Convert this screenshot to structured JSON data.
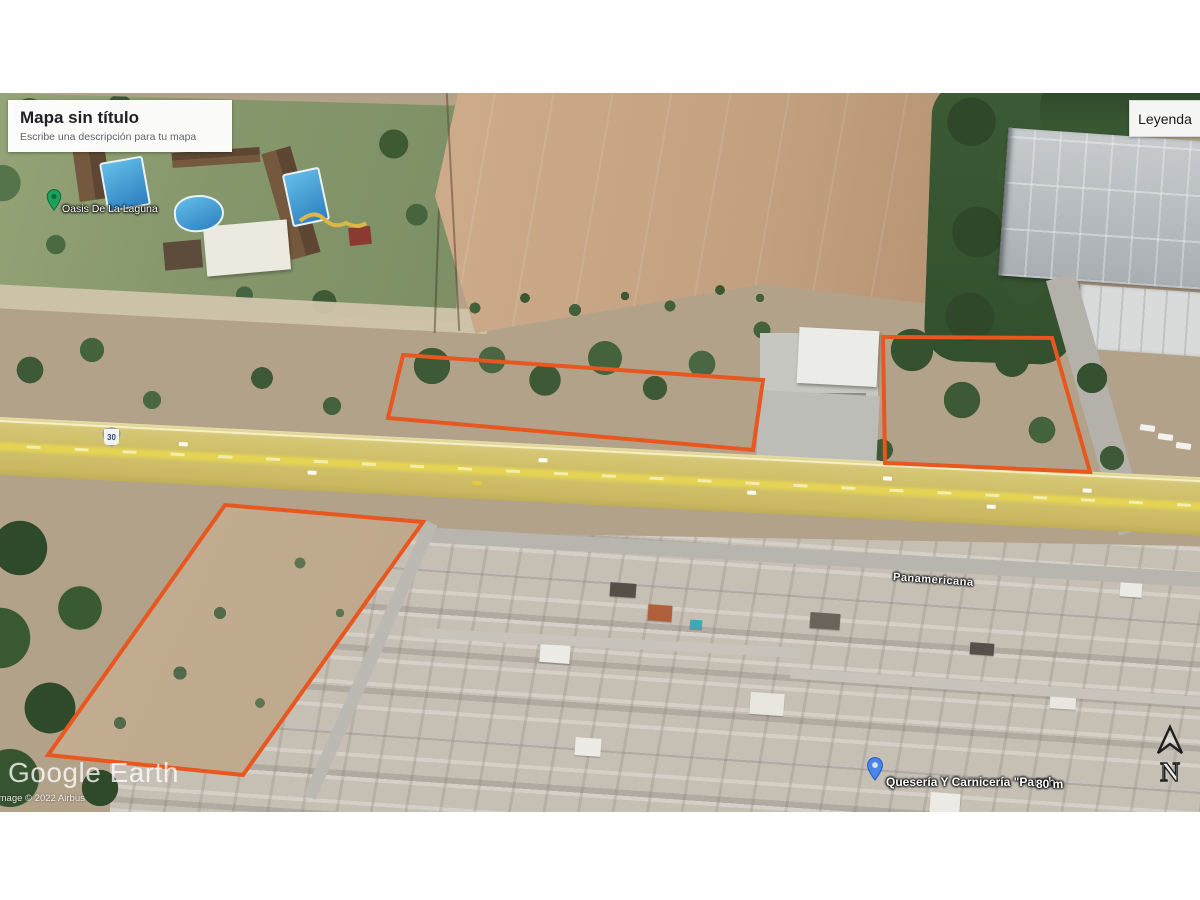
{
  "header": {
    "title": "Mapa sin título",
    "subtitle": "Escribe una descripción para tu mapa"
  },
  "legend_button": {
    "label": "Leyenda"
  },
  "map": {
    "labels": {
      "place_topleft": "Oasis De La Laguna",
      "street": "Panamericana",
      "poi_bottom": "Quesería Y Carnicería \"Panch",
      "scale": "80 m",
      "route_shield": "30",
      "compass_letter": "N"
    },
    "watermark": "Google Earth",
    "copyright": "Image © 2022 Airbus",
    "colors": {
      "parcel_stroke": "#e8571f",
      "highway_yellow": "#d5c471",
      "pin_green": "#1ea05a",
      "pin_blue": "#4a86e8"
    },
    "parcels": [
      {
        "name": "parcel-north-center",
        "points": [
          [
            403,
            262
          ],
          [
            763,
            287
          ],
          [
            753,
            357
          ],
          [
            388,
            325
          ]
        ]
      },
      {
        "name": "parcel-north-east",
        "points": [
          [
            883,
            244
          ],
          [
            1052,
            245
          ],
          [
            1090,
            379
          ],
          [
            885,
            370
          ]
        ]
      },
      {
        "name": "parcel-south-west",
        "points": [
          [
            225,
            412
          ],
          [
            423,
            429
          ],
          [
            243,
            682
          ],
          [
            48,
            662
          ]
        ]
      }
    ]
  }
}
